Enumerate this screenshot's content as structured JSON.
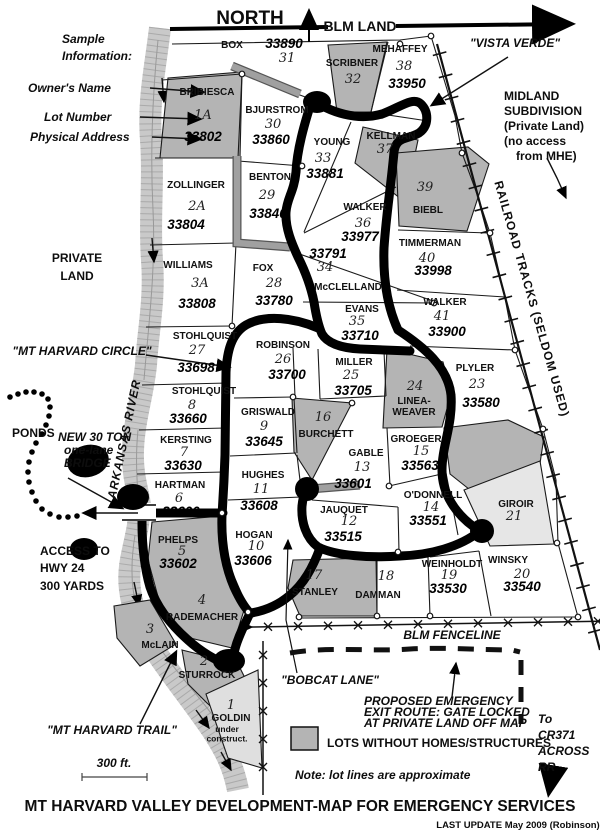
{
  "header": {
    "north": "NORTH",
    "blm_land": "BLM LAND"
  },
  "sample": {
    "heading1": "Sample",
    "heading2": "Information:",
    "owner": "Owner's Name",
    "lot": "Lot Number",
    "address": "Physical Address"
  },
  "labels": {
    "vista_verde": "\"VISTA VERDE\"",
    "midland": [
      "MIDLAND",
      "SUBDIVISION",
      "(Private Land)",
      "(no access",
      "from MHE)"
    ],
    "railroad": "RAILROAD TRACKS (SELDOM USED)",
    "private_land": [
      "PRIVATE",
      "LAND"
    ],
    "mt_harvard_circle": "\"MT HARVARD CIRCLE\"",
    "ponds": "PONDS",
    "bridge": [
      "NEW 30 TON",
      "one-lane",
      "BRIDGE"
    ],
    "arkansas_river": "ARKANSAS RIVER",
    "access": [
      "ACCESS TO",
      "HWY 24",
      "300 YARDS"
    ],
    "mt_harvard_trail": "\"MT HARVARD TRAIL\"",
    "scale": "300 ft.",
    "blm_fenceline": "BLM FENCELINE",
    "bobcat_lane": "\"BOBCAT LANE\"",
    "proposed": [
      "PROPOSED  EMERGENCY",
      "EXIT ROUTE: GATE LOCKED",
      "AT PRIVATE LAND OFF MAP"
    ],
    "legend_gray": "LOTS WITHOUT HOMES/STRUCTURES",
    "note": "Note: lot lines are approximate",
    "to_cr371": [
      "To",
      "CR371",
      "ACROSS",
      "RR"
    ]
  },
  "footer": {
    "title": "MT HARVARD VALLEY DEVELOPMENT-MAP FOR EMERGENCY SERVICES",
    "last_update": "LAST UPDATE May 2009 (Robinson)"
  },
  "colors": {
    "shaded_lot": "#b4b4b4",
    "light_lot": "#dfdfdf",
    "river": "#c9c9c9",
    "road": "#000000",
    "driveway": "#a0a0a0"
  },
  "lots": [
    {
      "name": "BOX",
      "num": "31",
      "addr": "33890",
      "shaded": false,
      "nx": 232,
      "ny": 48,
      "ux": 287,
      "uy": 62,
      "ax": 284,
      "ay": 48
    },
    {
      "name": "BRIBIESCA",
      "num": "1A",
      "addr": "33802",
      "shaded": true,
      "nx": 207,
      "ny": 95,
      "ux": 203,
      "uy": 119,
      "ax": 203,
      "ay": 141
    },
    {
      "name": "BJURSTROM",
      "num": "30",
      "addr": "33860",
      "shaded": false,
      "nx": 277,
      "ny": 113,
      "ux": 273,
      "uy": 128,
      "ax": 271,
      "ay": 144
    },
    {
      "name": "SCRIBNER",
      "num": "32",
      "shaded": true,
      "nx": 352,
      "ny": 66,
      "ux": 353,
      "uy": 83
    },
    {
      "name": "MEHAFFEY",
      "num": "38",
      "addr": "33950",
      "shaded": false,
      "nx": 400,
      "ny": 52,
      "ux": 404,
      "uy": 70,
      "ax": 407,
      "ay": 88
    },
    {
      "name": "KELLMAN",
      "num": "37",
      "shaded": true,
      "nx": 391,
      "ny": 139,
      "ux": 385,
      "uy": 153
    },
    {
      "name": "YOUNG",
      "num": "33",
      "addr": "33881",
      "shaded": false,
      "nx": 332,
      "ny": 145,
      "ux": 323,
      "uy": 162,
      "ax": 325,
      "ay": 178
    },
    {
      "name": "BENTON",
      "num": "29",
      "addr": "33840",
      "shaded": false,
      "nx": 270,
      "ny": 180,
      "ux": 267,
      "uy": 199,
      "ax": 268,
      "ay": 218
    },
    {
      "name": "ZOLLINGER",
      "num": "2A",
      "addr": "33804",
      "shaded": false,
      "nx": 196,
      "ny": 188,
      "ux": 197,
      "uy": 210,
      "ax": 186,
      "ay": 229
    },
    {
      "name": "BIEBL",
      "num": "39",
      "shaded": true,
      "nx": 428,
      "ny": 213,
      "ux": 425,
      "uy": 191
    },
    {
      "name": "WALKER",
      "num": "36",
      "addr": "33977",
      "shaded": false,
      "nx": 365,
      "ny": 210,
      "ux": 363,
      "uy": 227,
      "ax": 360,
      "ay": 241
    },
    {
      "name": "TIMMERMAN",
      "num": "40",
      "addr": "33998",
      "shaded": false,
      "nx": 430,
      "ny": 246,
      "ux": 427,
      "uy": 262,
      "ax": 433,
      "ay": 275
    },
    {
      "name": "McCLELLAND",
      "num": "34",
      "addr": "33791",
      "shaded": false,
      "nx": 348,
      "ny": 290,
      "ux": 325,
      "uy": 271,
      "ax": 328,
      "ay": 258
    },
    {
      "name": "WILLIAMS",
      "num": "3A",
      "addr": "33808",
      "shaded": false,
      "nx": 188,
      "ny": 268,
      "ux": 200,
      "uy": 287,
      "ax": 197,
      "ay": 308
    },
    {
      "name": "FOX",
      "num": "28",
      "addr": "33780",
      "shaded": false,
      "nx": 263,
      "ny": 271,
      "ux": 274,
      "uy": 287,
      "ax": 274,
      "ay": 305
    },
    {
      "name": "EVANS",
      "num": "35",
      "addr": "33710",
      "shaded": false,
      "big": true,
      "nx": 362,
      "ny": 312,
      "ux": 357,
      "uy": 325,
      "ax": 360,
      "ay": 340
    },
    {
      "name": "WALKER",
      "num": "41",
      "addr": "33900",
      "shaded": false,
      "nx": 445,
      "ny": 305,
      "ux": 442,
      "uy": 320,
      "ax": 447,
      "ay": 336
    },
    {
      "name": "STOHLQUIST",
      "num": "27",
      "addr": "33698",
      "shaded": false,
      "nx": 205,
      "ny": 339,
      "ux": 197,
      "uy": 354,
      "ax": 196,
      "ay": 372
    },
    {
      "name": "ROBINSON",
      "num": "26",
      "addr": "33700",
      "shaded": false,
      "nx": 283,
      "ny": 348,
      "ux": 283,
      "uy": 363,
      "ax": 287,
      "ay": 379
    },
    {
      "name": "MILLER",
      "num": "25",
      "addr": "33705",
      "shaded": false,
      "nx": 354,
      "ny": 365,
      "ux": 351,
      "uy": 379,
      "ax": 353,
      "ay": 395
    },
    {
      "name": "LINEA-\nWEAVER",
      "num": "24",
      "shaded": true,
      "nx": 414,
      "ny": 404,
      "ux": 415,
      "uy": 390
    },
    {
      "name": "PLYLER",
      "num": "23",
      "addr": "33580",
      "shaded": false,
      "nx": 475,
      "ny": 371,
      "ux": 477,
      "uy": 388,
      "ax": 481,
      "ay": 407
    },
    {
      "name": "STOHLQUIST",
      "num": "8",
      "addr": "33660",
      "shaded": false,
      "nx": 204,
      "ny": 394,
      "ux": 192,
      "uy": 409,
      "ax": 188,
      "ay": 423
    },
    {
      "name": "GRISWALD",
      "num": "9",
      "addr": "33645",
      "shaded": false,
      "nx": 268,
      "ny": 415,
      "ux": 264,
      "uy": 430,
      "ax": 264,
      "ay": 446
    },
    {
      "name": "BURCHETT",
      "num": "16",
      "shaded": true,
      "nx": 326,
      "ny": 437,
      "ux": 323,
      "uy": 421
    },
    {
      "name": "KERSTING",
      "num": "7",
      "addr": "33630",
      "shaded": false,
      "nx": 186,
      "ny": 443,
      "ux": 184,
      "uy": 456,
      "ax": 183,
      "ay": 470
    },
    {
      "name": "GABLE",
      "num": "13",
      "addr": "33601",
      "shaded": false,
      "nx": 366,
      "ny": 456,
      "ux": 362,
      "uy": 471,
      "ax": 353,
      "ay": 488
    },
    {
      "name": "GROEGER",
      "num": "15",
      "addr": "33563",
      "shaded": false,
      "nx": 416,
      "ny": 442,
      "ux": 421,
      "uy": 455,
      "ax": 420,
      "ay": 470
    },
    {
      "name": "HARTMAN",
      "num": "6",
      "addr": "33600",
      "shaded": false,
      "nx": 180,
      "ny": 488,
      "ux": 179,
      "uy": 502,
      "ax": 181,
      "ay": 516
    },
    {
      "name": "HUGHES",
      "num": "11",
      "addr": "33608",
      "shaded": false,
      "nx": 263,
      "ny": 478,
      "ux": 261,
      "uy": 493,
      "ax": 259,
      "ay": 510
    },
    {
      "name": "O'DONNELL",
      "num": "14",
      "addr": "33551",
      "shaded": false,
      "nx": 433,
      "ny": 498,
      "ux": 431,
      "uy": 511,
      "ax": 428,
      "ay": 525
    },
    {
      "name": "JAUQUET",
      "num": "12",
      "addr": "33515",
      "shaded": false,
      "nx": 344,
      "ny": 513,
      "ux": 349,
      "uy": 525,
      "ax": 343,
      "ay": 541
    },
    {
      "name": "GIROIR",
      "num": "21",
      "shaded": "light",
      "nx": 516,
      "ny": 507,
      "ux": 514,
      "uy": 520
    },
    {
      "name": "PHELPS",
      "num": "5",
      "addr": "33602",
      "shaded": false,
      "nx": 178,
      "ny": 543,
      "ux": 182,
      "uy": 555,
      "ax": 178,
      "ay": 568
    },
    {
      "name": "HOGAN",
      "num": "10",
      "addr": "33606",
      "shaded": false,
      "nx": 254,
      "ny": 538,
      "ux": 256,
      "uy": 550,
      "ax": 253,
      "ay": 565
    },
    {
      "name": "STANLEY",
      "num": "17",
      "shaded": true,
      "nx": 315,
      "ny": 595,
      "ux": 314,
      "uy": 579
    },
    {
      "name": "DAMMAN",
      "num": "18",
      "shaded": false,
      "nx": 378,
      "ny": 598,
      "ux": 386,
      "uy": 580
    },
    {
      "name": "WEINHOLDT",
      "num": "19",
      "addr": "33530",
      "shaded": false,
      "nx": 452,
      "ny": 567,
      "ux": 449,
      "uy": 579,
      "ax": 448,
      "ay": 593
    },
    {
      "name": "WINSKY",
      "num": "20",
      "addr": "33540",
      "shaded": false,
      "nx": 508,
      "ny": 563,
      "ux": 522,
      "uy": 578,
      "ax": 522,
      "ay": 591
    },
    {
      "name": "RADEMACHER",
      "num": "4",
      "shaded": true,
      "nx": 202,
      "ny": 620,
      "ux": 202,
      "uy": 604
    },
    {
      "name": "McLAIN",
      "num": "3",
      "shaded": true,
      "nx": 160,
      "ny": 648,
      "ux": 150,
      "uy": 633
    },
    {
      "name": "STURROCK",
      "num": "2",
      "shaded": true,
      "nx": 207,
      "ny": 678,
      "ux": 204,
      "uy": 665
    },
    {
      "name": "GOLDIN",
      "num": "1",
      "shaded": "light",
      "nx": 231,
      "ny": 721,
      "ux": 231,
      "uy": 709,
      "note": "under\nconstruct.",
      "tx": 227,
      "ty": 732
    }
  ]
}
